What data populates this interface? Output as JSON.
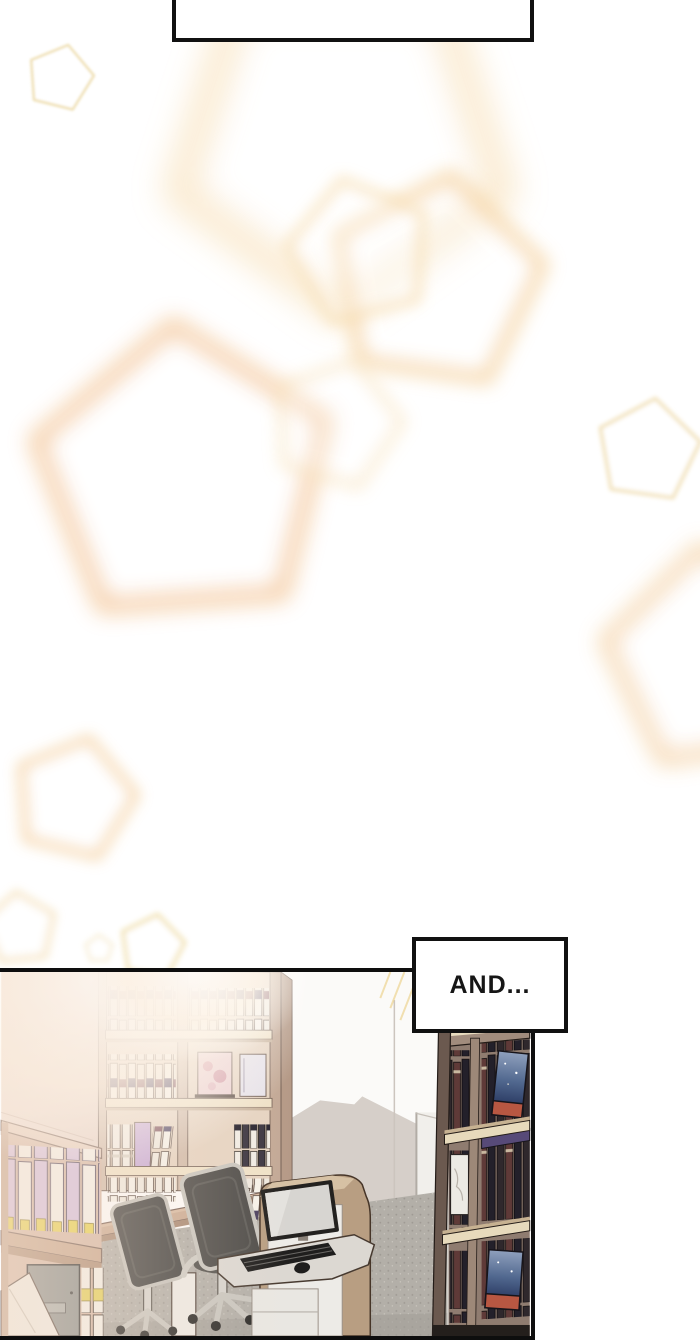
{
  "page": {
    "width": 700,
    "height": 1343,
    "background": "#ffffff"
  },
  "speech_bubble_top": {
    "text": ""
  },
  "caption": {
    "text": "AND..."
  },
  "palette": {
    "panel_border": "#0e0e0e",
    "bubble_border": "#111111",
    "glow_accent": "#f4cf9e",
    "wood_light": "#e6d4c2",
    "wood_mid": "#c9a88f",
    "wood_dark": "#8f7c70",
    "wall_white": "#fbfaf8",
    "wall_shadow": "#d6cfc9",
    "carpet_gray": "#b3afa8",
    "chair_dark": "#4e4c49",
    "chair_frame": "#c9c6bf",
    "kiosk_tan": "#b89e82",
    "monitor_screen": "#d7d5d1",
    "book_navy": "#4a3f5f",
    "book_lavender": "#d4bede",
    "label_yellow": "#e7d152",
    "cover_night_blue": "#51688f",
    "cover_flame": "#b85742"
  },
  "decor": {
    "pentagons": [
      {
        "cx": 60,
        "cy": 78,
        "r": 34,
        "rot": 14,
        "stroke": "#eddcab",
        "w": 2.5,
        "blur": 1.2,
        "op": 0.9
      },
      {
        "cx": 340,
        "cy": 140,
        "r": 170,
        "rot": 36,
        "stroke": "#f7ddb0",
        "w": 26,
        "blur": 17,
        "op": 0.75
      },
      {
        "cx": 436,
        "cy": 283,
        "r": 108,
        "rot": 8,
        "stroke": "#f5d3a0",
        "w": 13,
        "blur": 9,
        "op": 0.85
      },
      {
        "cx": 360,
        "cy": 252,
        "r": 74,
        "rot": -14,
        "stroke": "#f8e0b6",
        "w": 9,
        "blur": 7,
        "op": 0.8
      },
      {
        "cx": 184,
        "cy": 477,
        "r": 152,
        "rot": -4,
        "stroke": "#f4c89a",
        "w": 15,
        "blur": 11,
        "op": 0.95
      },
      {
        "cx": 336,
        "cy": 424,
        "r": 66,
        "rot": 16,
        "stroke": "#f8e3bd",
        "w": 8,
        "blur": 8,
        "op": 0.75
      },
      {
        "cx": 648,
        "cy": 451,
        "r": 53,
        "rot": 8,
        "stroke": "#efdcae",
        "w": 3.5,
        "blur": 2.2,
        "op": 0.85
      },
      {
        "cx": 716,
        "cy": 660,
        "r": 112,
        "rot": -8,
        "stroke": "#f4cf9e",
        "w": 13,
        "blur": 11,
        "op": 0.9
      },
      {
        "cx": 74,
        "cy": 799,
        "r": 62,
        "rot": 14,
        "stroke": "#f5d2a2",
        "w": 8,
        "blur": 7,
        "op": 0.9
      },
      {
        "cx": 20,
        "cy": 929,
        "r": 37,
        "rot": -6,
        "stroke": "#f2d8a6",
        "w": 5,
        "blur": 4.5,
        "op": 0.7
      },
      {
        "cx": 152,
        "cy": 947,
        "r": 33,
        "rot": 10,
        "stroke": "#eeda9f",
        "w": 3.5,
        "blur": 3,
        "op": 0.85
      },
      {
        "cx": 99,
        "cy": 949,
        "r": 14,
        "rot": 0,
        "stroke": "#f1dfb2",
        "w": 3,
        "blur": 3,
        "op": 0.55
      }
    ]
  }
}
